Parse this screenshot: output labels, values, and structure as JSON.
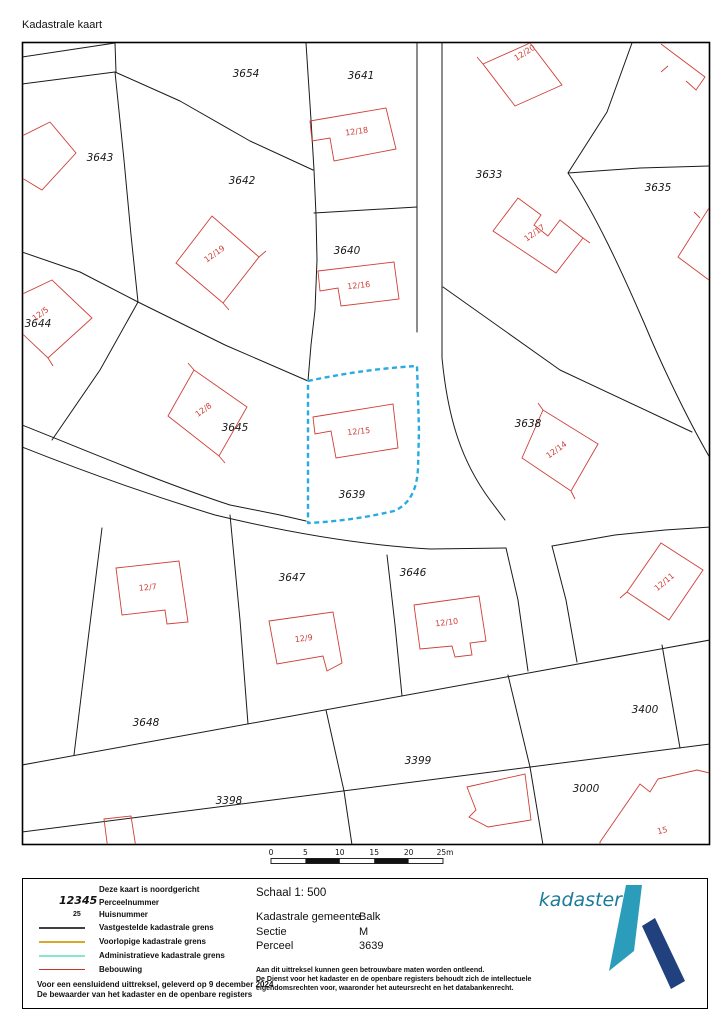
{
  "title": "Kadastrale kaart",
  "colors": {
    "boundary": "#1a1a1a",
    "building": "#cf3f38",
    "highlight": "#29abe2",
    "vastgestelde": "#404040",
    "voorlopige": "#d9a62e",
    "administratieve": "#86e7cf",
    "bebouwing": "#c0392b",
    "logo_teal": "#1b7b9b",
    "logo_light": "#2b9cba",
    "logo_navy": "#20407e"
  },
  "map": {
    "highlight_parcel": "3639",
    "parcels": [
      {
        "label": "3654"
      },
      {
        "label": "3641"
      },
      {
        "label": "3643"
      },
      {
        "label": "3642"
      },
      {
        "label": "3633"
      },
      {
        "label": "3635"
      },
      {
        "label": "3640"
      },
      {
        "label": "3644"
      },
      {
        "label": "3645"
      },
      {
        "label": "3638"
      },
      {
        "label": "3639"
      },
      {
        "label": "3647"
      },
      {
        "label": "3646"
      },
      {
        "label": "3648"
      },
      {
        "label": "3398"
      },
      {
        "label": "3399"
      },
      {
        "label": "3400"
      },
      {
        "label": "3000"
      }
    ],
    "buildings": [
      {
        "label": "12/18"
      },
      {
        "label": "12/20"
      },
      {
        "label": "12/19"
      },
      {
        "label": "12/17"
      },
      {
        "label": "12/16"
      },
      {
        "label": "12/5"
      },
      {
        "label": "12/2"
      },
      {
        "label": "12/8"
      },
      {
        "label": "12/15"
      },
      {
        "label": "12/14"
      },
      {
        "label": "12/7"
      },
      {
        "label": "12/9"
      },
      {
        "label": "12/10"
      },
      {
        "label": "12/11"
      },
      {
        "label": "15"
      }
    ]
  },
  "scalebar": {
    "ticks": [
      "0",
      "5",
      "10",
      "15",
      "20",
      "25m"
    ]
  },
  "legend": {
    "north_note": "Deze kaart is noordgericht",
    "parcel_sample": "12345",
    "parcel_label": "Perceelnummer",
    "house_sample": "25",
    "house_label": "Huisnummer",
    "line_vastgestelde": "Vastgestelde kadastrale grens",
    "line_voorlopige": "Voorlopige kadastrale grens",
    "line_administratieve": "Administratieve kadastrale grens",
    "line_bebouwing": "Bebouwing",
    "footer1": "Voor een eensluidend uittreksel, geleverd op 9 december 2024",
    "footer2": "De bewaarder van het kadaster en de openbare registers"
  },
  "info": {
    "schaal": "Schaal 1: 500",
    "rows": [
      {
        "label": "Kadastrale gemeente",
        "value": "Balk"
      },
      {
        "label": "Sectie",
        "value": "M"
      },
      {
        "label": "Perceel",
        "value": "3639"
      }
    ],
    "disclaimer1": "Aan dit uittreksel kunnen geen betrouwbare maten worden ontleend.",
    "disclaimer2": "De Dienst voor het kadaster en de openbare registers behoudt zich de intellectuele",
    "disclaimer3": "eigendomsrechten voor, waaronder het auteursrecht en het databankenrecht.",
    "logo_text": "kadaster"
  }
}
